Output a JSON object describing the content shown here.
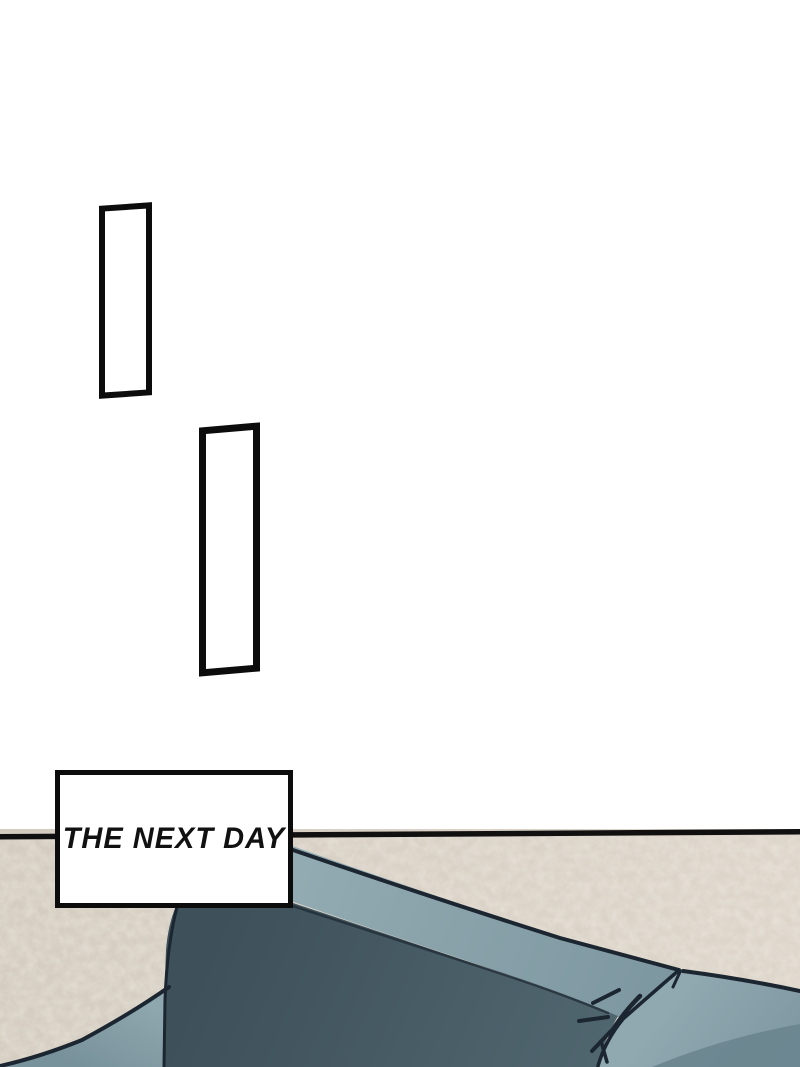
{
  "caption": {
    "text": "THE NEXT DAY"
  },
  "panels": {
    "empty_panel_count": 2,
    "description_1": "tall empty rectangle panel",
    "description_2": "tall empty rectangle panel"
  },
  "colors": {
    "page_bg": "#ffffff",
    "ink": "#0c0c0c",
    "caption_bg": "#ffffff",
    "wall_left": "#d4ccc0",
    "wall_right": "#ddd5ca",
    "line_color": "#101010",
    "outline": "#1b2631",
    "band_light": "#92aab1",
    "band_dark": "#7d97a1",
    "dark_top": "#3e505a",
    "dark_bottom": "#50666f",
    "cushion_light": "#90a8b0",
    "cushion_dark": "#7e98a2",
    "cushion_front": "#6a848e",
    "wedge_light": "#8ea6ad",
    "wedge_dark": "#78929c"
  }
}
